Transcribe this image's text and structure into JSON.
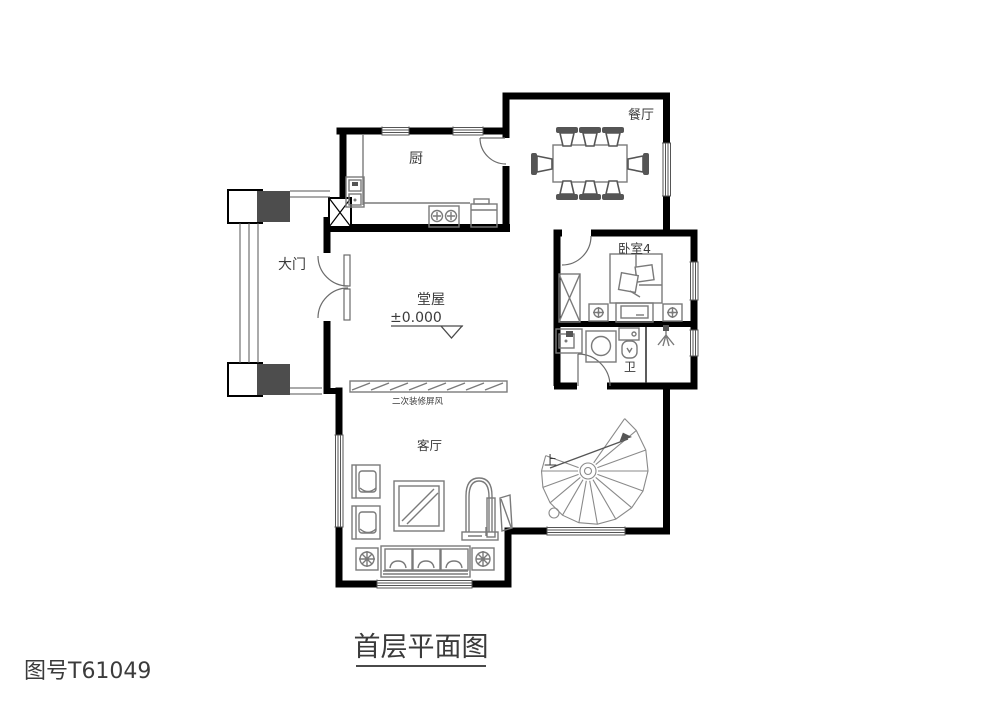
{
  "drawing": {
    "number": "图号T61049",
    "title": "首层平面图"
  },
  "labels": {
    "kitchen": "厨",
    "dining": "餐厅",
    "entrance": "大门",
    "hall": "堂屋",
    "elevation": "±0.000",
    "screen": "二次装修屏风",
    "bedroom4": "卧室4",
    "bathroom": "卫",
    "living": "客厅",
    "stairs_up": "上"
  },
  "colors": {
    "wall": "#000000",
    "furniture_line": "#7a7a7a",
    "dark_fill": "#555555",
    "text": "#3b3b3b",
    "background": "#ffffff"
  }
}
